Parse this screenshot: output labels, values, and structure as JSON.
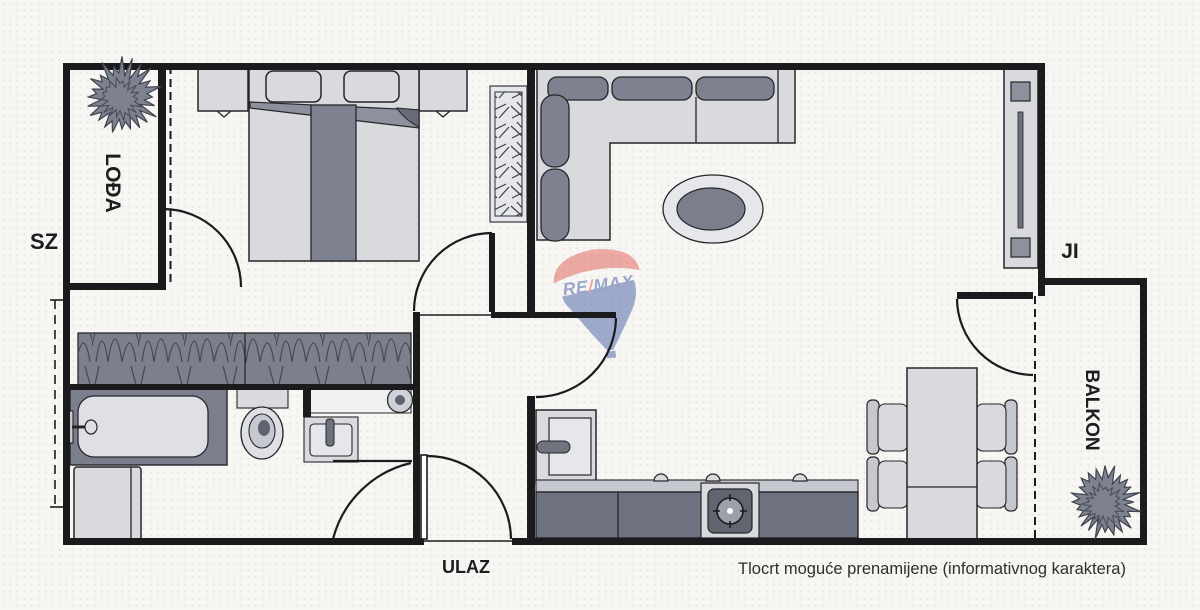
{
  "plan": {
    "compass": {
      "northwest": "SZ",
      "southeast": "JI"
    },
    "rooms": {
      "loggia": "LOĐA",
      "balcony": "BALKON",
      "entrance": "ULAZ"
    },
    "footnote": "Tlocrt moguće prenamijene (informativnog karaktera)",
    "watermark": {
      "re": "RE",
      "slash": "/",
      "max": "MAX"
    },
    "colors": {
      "wall": "#1b1b1d",
      "furniture_light": "#d9dade",
      "furniture_dark": "#7e8290",
      "counter": "#6e7280",
      "wood_closet": "#7c808d",
      "paper": "#f7f6f3",
      "remax_red": "#e04b44",
      "remax_blue": "#33509f"
    }
  }
}
